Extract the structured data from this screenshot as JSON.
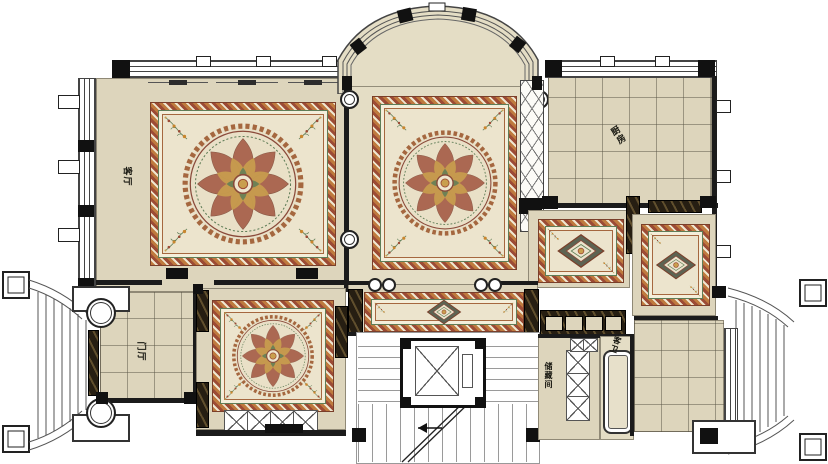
{
  "plan": {
    "type": "residential-floor-plan",
    "labels": {
      "living_room": "客厅",
      "kitchen": "厨房",
      "entrance_hall": "门厅",
      "guest_bath": "客卫",
      "storage_room": "储藏间"
    },
    "colors": {
      "floor_beige": "#ddd5bc",
      "rug_field": "#ece4cd",
      "rug_border_terracotta": "#bf7a3e",
      "wall_black": "#1b1b1b",
      "marble_dark": "#261e12",
      "accent_green": "#5f7d57",
      "accent_red": "#9c4b35",
      "accent_gold": "#c99f4e"
    }
  }
}
